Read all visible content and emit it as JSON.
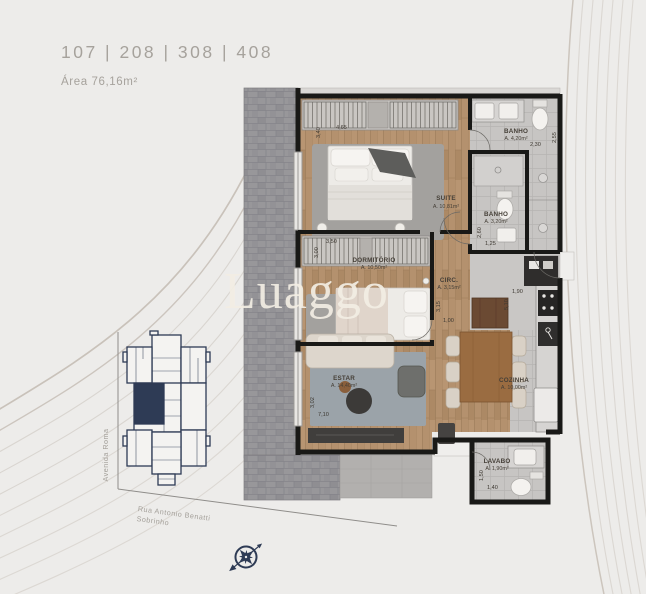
{
  "header": {
    "units": "107 | 208 | 308 | 408",
    "area_label": "Área 76,16m²"
  },
  "watermark": "Luaggo",
  "plan": {
    "rooms": {
      "suite": {
        "name": "SUITE",
        "area": "A. 10,81m²",
        "dim_top": "4,65",
        "dim_side": "3,40"
      },
      "banho_suite": {
        "name": "BANHO",
        "area": "A. 4,20m²",
        "dim_top": "2,30",
        "dim_side": "2,55"
      },
      "banho_social": {
        "name": "BANHO",
        "area": "A. 3,20m²",
        "dim_top": "1,25",
        "dim_side": "2,60"
      },
      "dormitorio": {
        "name": "DORMITÓRIO",
        "area": "A. 10,50m²",
        "dim_top": "3,50",
        "dim_side": "3,00"
      },
      "circ": {
        "name": "CIRC.",
        "area": "A. 3,15m²",
        "dim_top": "1,00",
        "dim_side": "3,15"
      },
      "estar": {
        "name": "ESTAR",
        "area": "A. 14,40m²",
        "dim_top": "7,10",
        "dim_side": "3,02"
      },
      "cozinha": {
        "name": "COZINHA",
        "area": "A. 10,00m²",
        "dim_top": "1,90",
        "dim_side": "5,10"
      },
      "lavabo": {
        "name": "LAVABO",
        "area": "A. 1,90m²",
        "dim_top": "1,40",
        "dim_side": "1,50"
      }
    }
  },
  "key_plan": {
    "street_vertical": "Avenida Roma",
    "street_diagonal_line1": "Rua Antonio Benatti",
    "street_diagonal_line2": "Sobrinho"
  },
  "colors": {
    "accent_navy": "#2e3b55",
    "wall_black": "#191917",
    "header_text": "#a6a29c",
    "wood_floor": "#b4916e",
    "paver_grey": "#98979a"
  }
}
